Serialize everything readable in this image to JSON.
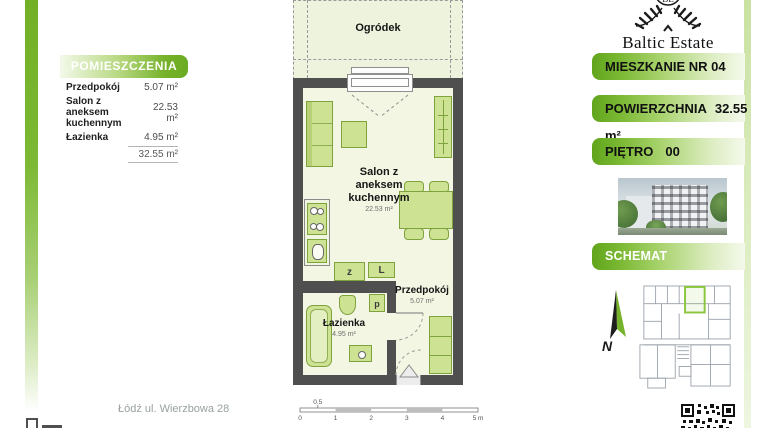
{
  "header": {
    "brand": "Baltic Estate"
  },
  "legend": {
    "title": "POMIESZCZENIA",
    "rows": [
      {
        "label": "Przedpokój",
        "value": "5.07 m²"
      },
      {
        "label": "Salon z aneksem kuchennym",
        "value": "22.53 m²"
      },
      {
        "label": "Łazienka",
        "value": "4.95 m²"
      }
    ],
    "total": "32.55 m²"
  },
  "plan": {
    "garden": "Ogródek",
    "salon": {
      "name": "Salon z aneksem kuchennym",
      "area": "22.53 m²"
    },
    "hall": {
      "name": "Przedpokój",
      "area": "5.07 m²"
    },
    "bath": {
      "name": "Łazienka",
      "area": "4.95 m²"
    },
    "appliances": {
      "dishwasher": "z",
      "fridge": "L",
      "washer": "p"
    },
    "scale_labels": [
      "0",
      "0.5",
      "1",
      "2",
      "3",
      "4",
      "5 m"
    ]
  },
  "sidebar": {
    "unit_label": "MIESZKANIE NR 04",
    "area_label": "POWIERZCHNIA",
    "area_value": "32.55 m²",
    "floor_label": "PIĘTRO",
    "floor_value": "00",
    "schematic_label": "SCHEMAT KONDYGNACJI",
    "north_label": "N"
  },
  "footer": {
    "address": "Łódź ul. Wierzbowa 28"
  },
  "colors": {
    "accent": "#76b22a",
    "wall": "#4f4f4f",
    "furniture": "#cde293",
    "floor": "#f2f6e2"
  }
}
